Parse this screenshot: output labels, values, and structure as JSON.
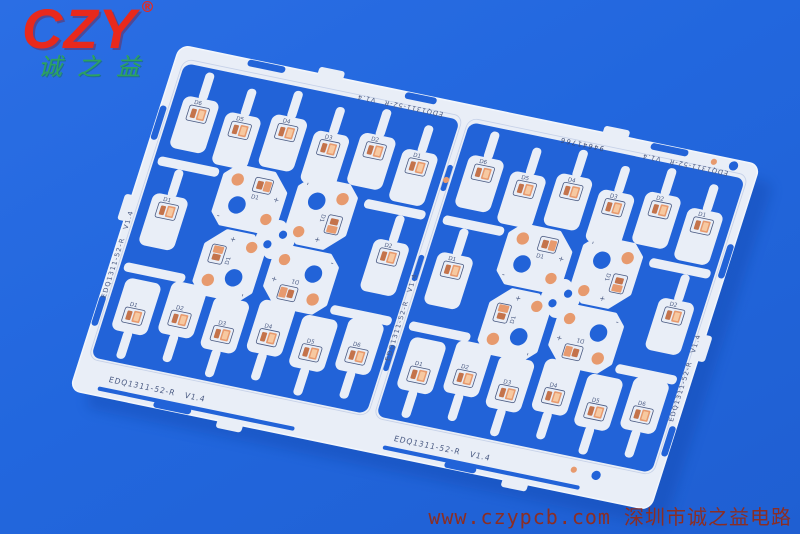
{
  "logo": {
    "text": "CZY",
    "registered": "®",
    "subtext": "诚之益",
    "color": "#e8291c",
    "subtext_color": "#2da35e"
  },
  "watermark": {
    "text": "www.czypcb.com 深圳市诚之益电路",
    "color": "#8b2e24"
  },
  "pcb": {
    "marking": "EDQ1311-52-R",
    "version": "V1.4",
    "serial": "94641766",
    "designators": [
      "D1",
      "D2",
      "D3",
      "D4",
      "D5",
      "D6"
    ],
    "plus": "+",
    "minus": "-",
    "colors": {
      "background": "#2267de",
      "panel": "#e9eef7",
      "panel_edge": "#f2f6fc",
      "slot": "#2263d8",
      "score": "#c6d1e8",
      "copper": "#e79a6e",
      "copper_dark": "#c4734b",
      "copper_light": "#f7c9a1",
      "silk": "#4a5a82",
      "serial_ink": "#3a4a74",
      "shadow": "#0a3c9e"
    }
  }
}
